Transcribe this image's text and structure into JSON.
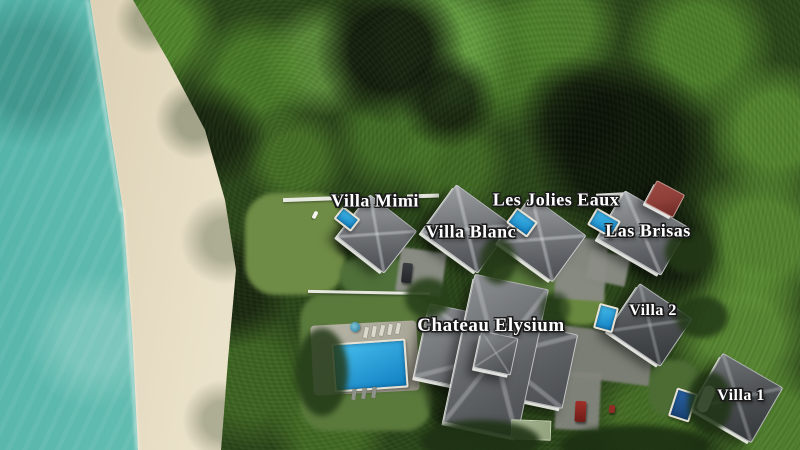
{
  "scene": {
    "type": "aerial-drone-photo",
    "description": "Aerial view of a beachfront resort: turquoise sea and white sand beach on the left, dense tropical forest elsewhere, seven labeled villas with gray hip roofs, blue swimming pools, a shared pool with sun loungers, gray driveways and white boundary walls."
  },
  "labels": {
    "villa_mimi": {
      "text": "Villa Mimi"
    },
    "villa_blanc": {
      "text": "Villa Blanc"
    },
    "les_jolies_eaux": {
      "text": "Les Jolies Eaux"
    },
    "las_brisas": {
      "text": "Las Brisas"
    },
    "chateau_elysium": {
      "text": "Chateau Elysium"
    },
    "villa_2": {
      "text": "Villa 2"
    },
    "villa_1": {
      "text": "Villa 1"
    }
  },
  "colors": {
    "ocean_turquoise": "#6ec3b7",
    "beach_sand": "#eae1c9",
    "forest_green": "#2b4619",
    "canopy_highlight": "#69a244",
    "lawn_green": "#6f8c46",
    "pool_blue": "#2aa3dc",
    "pool_navy": "#1d4f8a",
    "roof_gray": "#5c5f63",
    "roof_charcoal": "#3a3d40",
    "roof_red": "#8e3f38",
    "wall_white": "#f2f2ee",
    "label_text": "#ffffff",
    "label_outline": "#1a1a1a"
  }
}
